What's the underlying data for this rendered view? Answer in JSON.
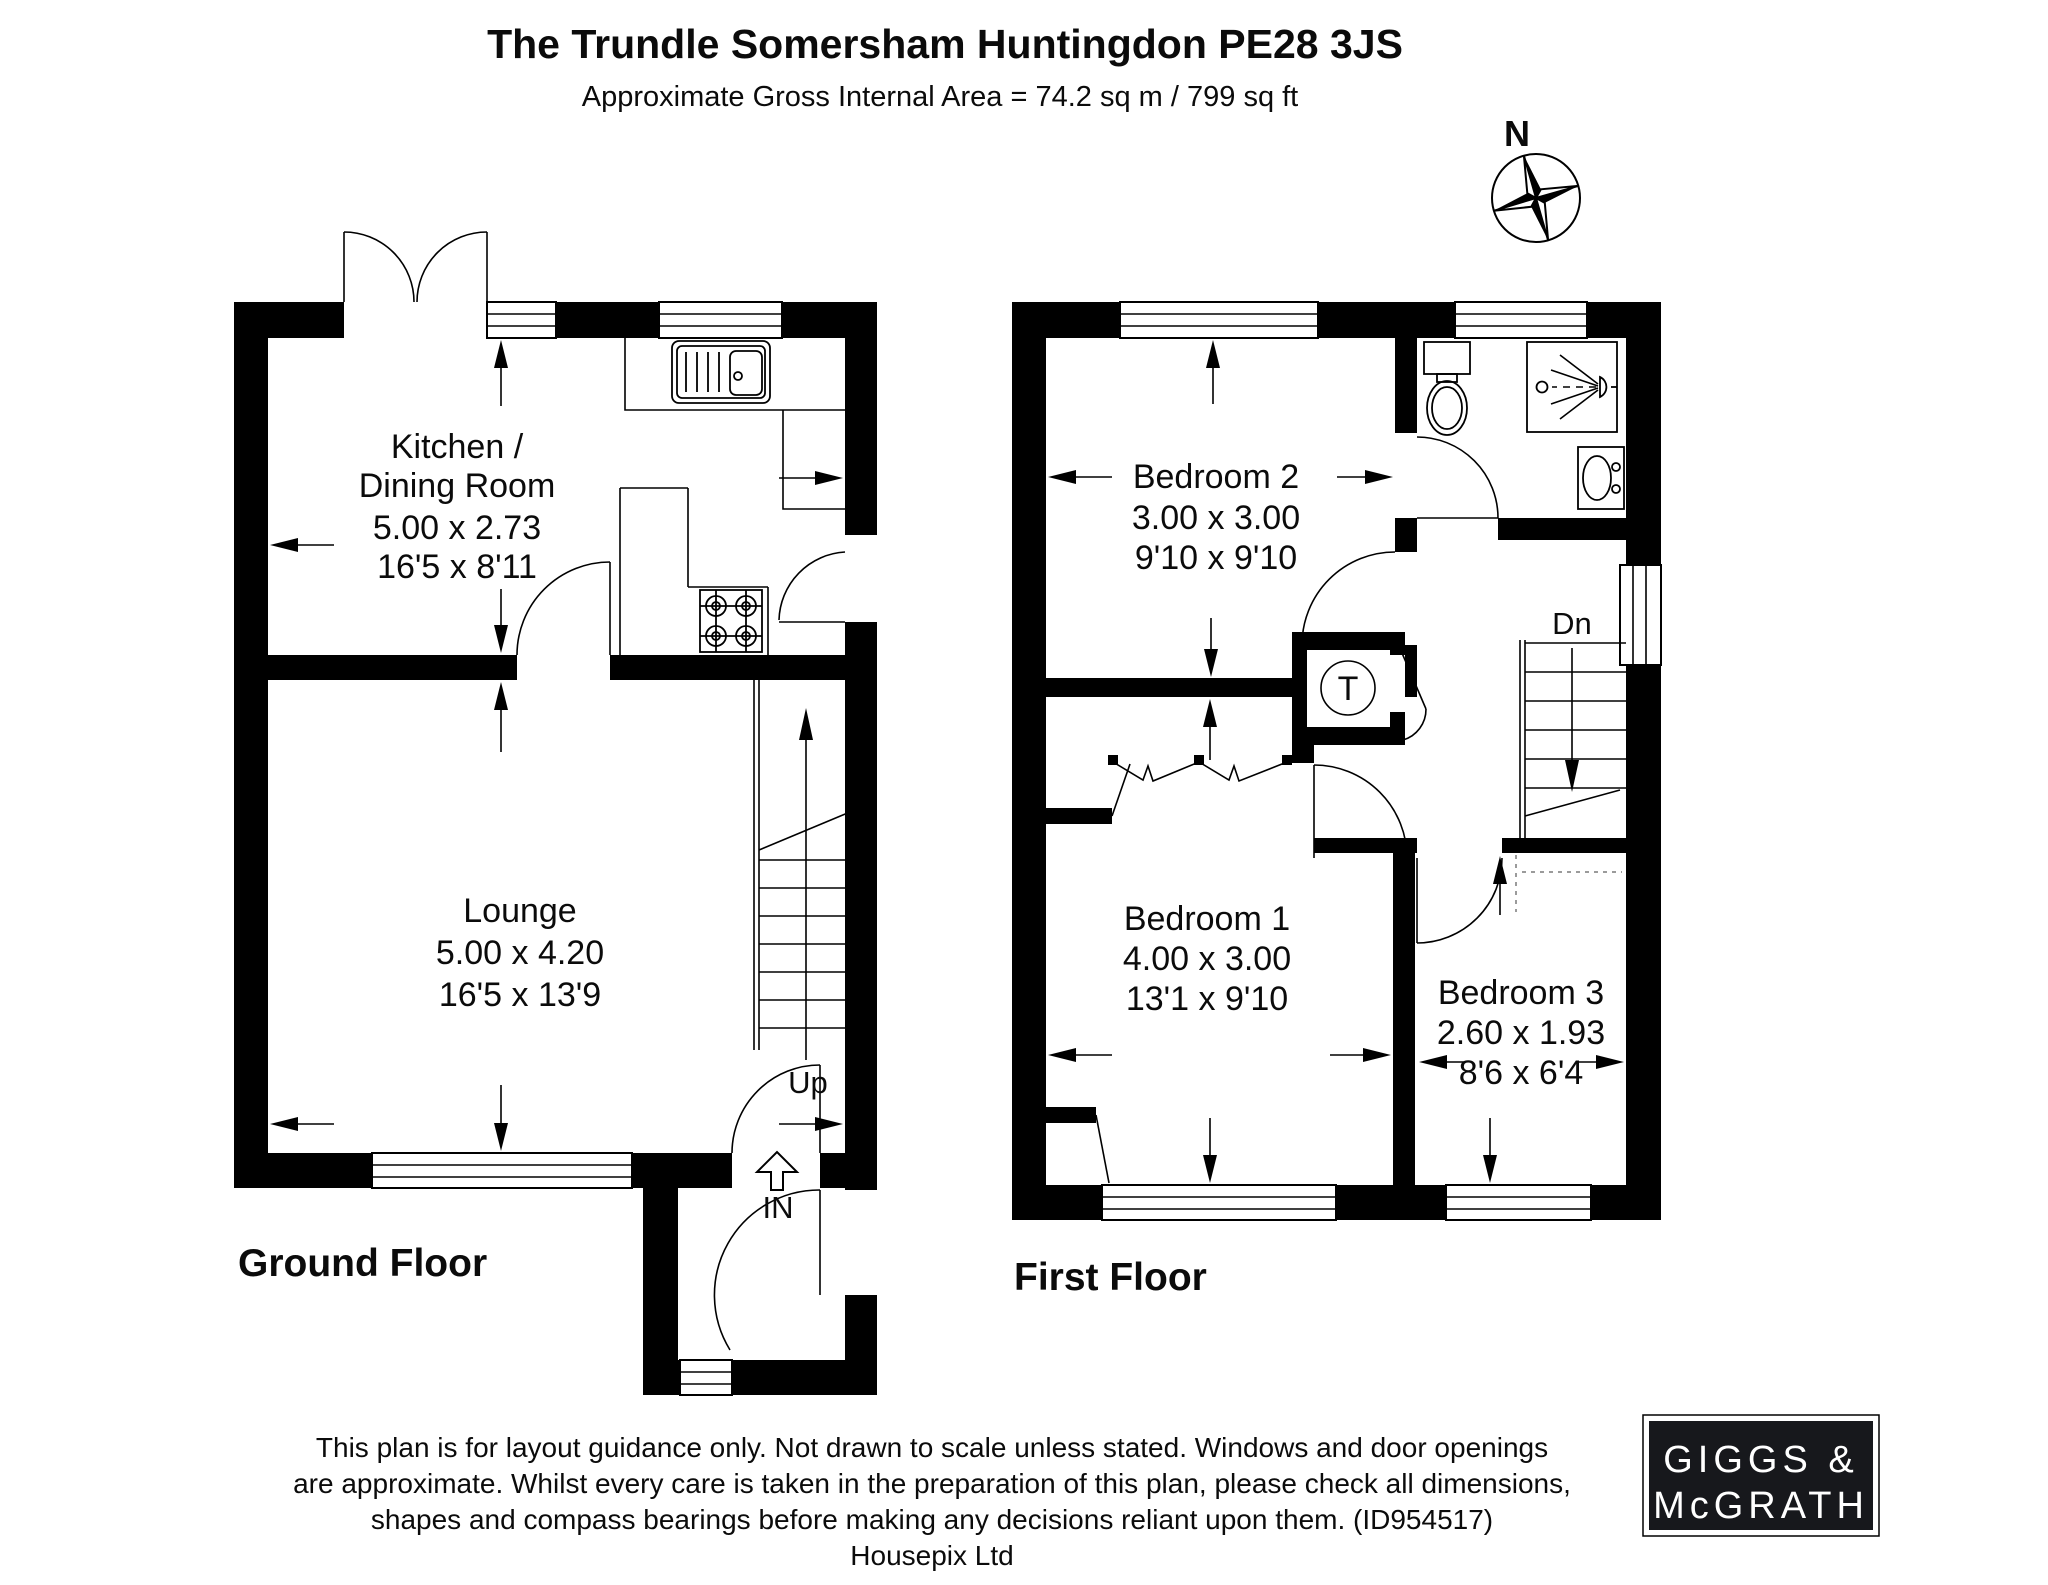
{
  "header": {
    "title": "The Trundle Somersham Huntingdon PE28 3JS",
    "subtitle": "Approximate Gross Internal Area = 74.2 sq m / 799 sq ft"
  },
  "compass": {
    "north_label": "N"
  },
  "ground_floor": {
    "label": "Ground Floor",
    "stairs_label": "Up",
    "entrance_label": "IN",
    "rooms": {
      "kitchen": {
        "name_line1": "Kitchen /",
        "name_line2": "Dining Room",
        "size_metric": "5.00 x 2.73",
        "size_imperial": "16'5 x 8'11"
      },
      "lounge": {
        "name": "Lounge",
        "size_metric": "5.00 x 4.20",
        "size_imperial": "16'5 x 13'9"
      }
    }
  },
  "first_floor": {
    "label": "First Floor",
    "stairs_label": "Dn",
    "tank_label": "T",
    "rooms": {
      "bedroom2": {
        "name": "Bedroom 2",
        "size_metric": "3.00 x 3.00",
        "size_imperial": "9'10 x 9'10"
      },
      "bedroom1": {
        "name": "Bedroom 1",
        "size_metric": "4.00 x 3.00",
        "size_imperial": "13'1 x 9'10"
      },
      "bedroom3": {
        "name": "Bedroom 3",
        "size_metric": "2.60 x 1.93",
        "size_imperial": "8'6 x 6'4"
      }
    }
  },
  "footer": {
    "disclaimer_line1": "This plan is for layout guidance only. Not drawn to scale unless stated. Windows and door openings",
    "disclaimer_line2": "are approximate. Whilst every care is taken in the preparation of this plan, please check all dimensions,",
    "disclaimer_line3": "shapes and compass bearings before making any decisions reliant upon them. (ID954517)",
    "credit": "Housepix Ltd"
  },
  "logo": {
    "line1": "GIGGS &",
    "line2": "McGRATH"
  },
  "colors": {
    "wall": "#000000",
    "background": "#ffffff",
    "logo_bg": "#17181c"
  }
}
